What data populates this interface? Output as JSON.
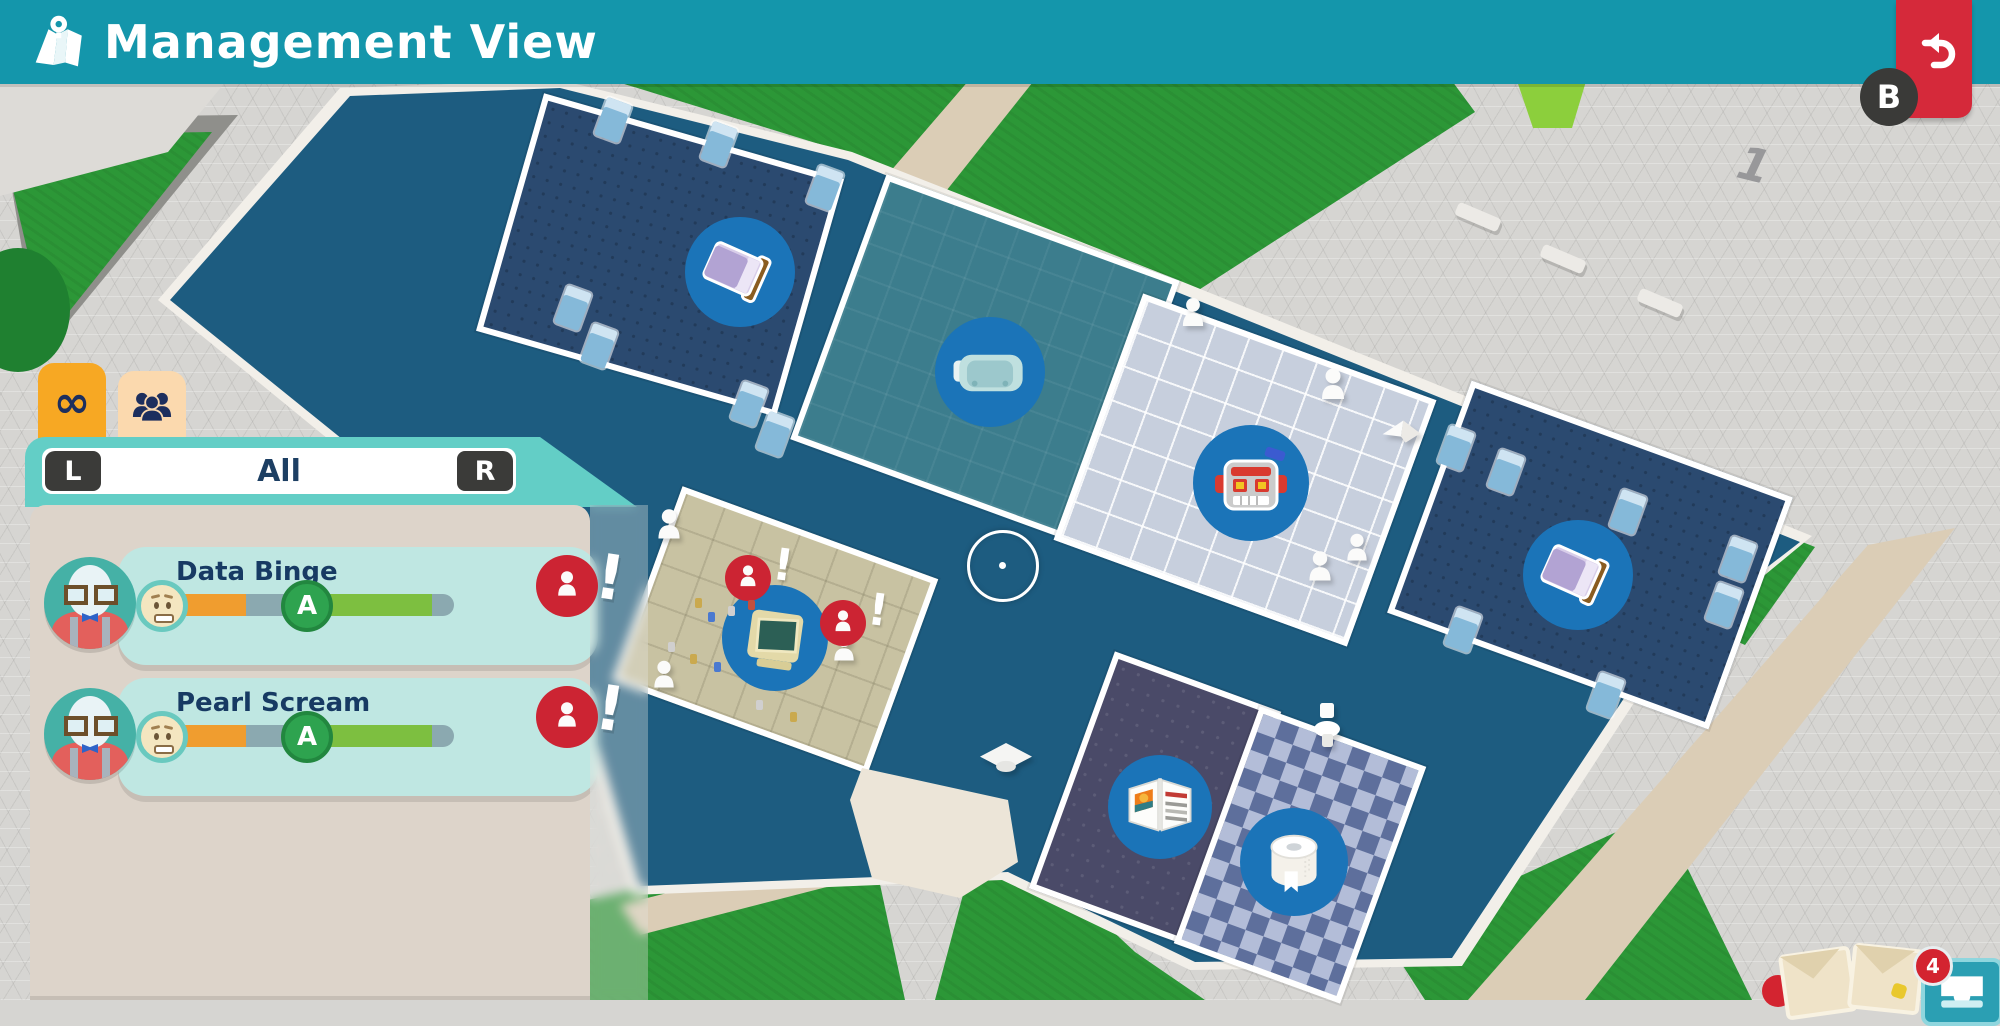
{
  "title_bar": {
    "title": "Management View",
    "icon": "map-icon"
  },
  "gamepad": {
    "back_button_label": "B"
  },
  "panel": {
    "tabs": [
      {
        "id": "loop",
        "glyph": "∞",
        "active": true
      },
      {
        "id": "people",
        "active": false
      }
    ],
    "filter": {
      "prev_label": "L",
      "value": "All",
      "next_label": "R"
    },
    "characters": [
      {
        "name": "Data Binge",
        "mood_pct": 56,
        "grade_label": "A",
        "grade_pct": 86,
        "alert": "!"
      },
      {
        "name": "Pearl Scream",
        "mood_pct": 56,
        "grade_label": "A",
        "grade_pct": 86,
        "alert": "!"
      }
    ]
  },
  "map": {
    "rooms": [
      {
        "id": "dormitory-west",
        "icon": "bed-icon"
      },
      {
        "id": "vr-room",
        "icon": "vr-headset-icon"
      },
      {
        "id": "robotics-room",
        "icon": "robot-icon"
      },
      {
        "id": "dormitory-east",
        "icon": "bed-icon"
      },
      {
        "id": "computer-lab",
        "icon": "computer-icon"
      },
      {
        "id": "library",
        "icon": "book-icon"
      },
      {
        "id": "toilets",
        "icon": "toilet-roll-icon"
      }
    ],
    "plaza_marker": "1",
    "alert_mark": "!",
    "inbox": {
      "badge_count": "4"
    }
  },
  "colors": {
    "teal_bar": "#1496ab",
    "header_teal": "#63cec6",
    "card_teal": "#bfe7e2",
    "panel_beige": "#ddd4ca",
    "accent_orange": "#f09d2f",
    "accent_green": "#7dbf40",
    "alert_red": "#cc2433",
    "floor_blue": "#1d5c80",
    "tab_orange": "#f7a823"
  }
}
